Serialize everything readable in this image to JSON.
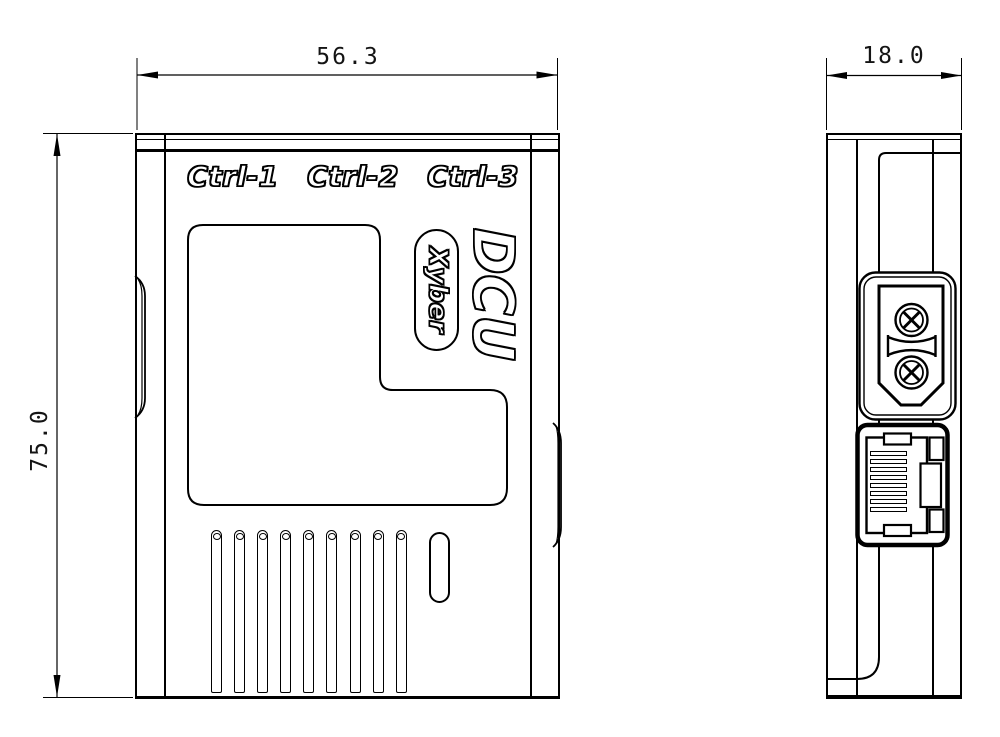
{
  "front_view": {
    "port_labels": [
      "Ctrl-1",
      "Ctrl-2",
      "Ctrl-3"
    ],
    "model_label": "DCU",
    "brand_label": "Xyber",
    "vent_count": 9
  },
  "side_view": {
    "rj45_pin_count": 8
  },
  "dimensions": {
    "width_mm": "56.3",
    "height_mm": "75.0",
    "depth_mm": "18.0"
  },
  "colors": {
    "line": "#000000",
    "background": "#ffffff"
  }
}
